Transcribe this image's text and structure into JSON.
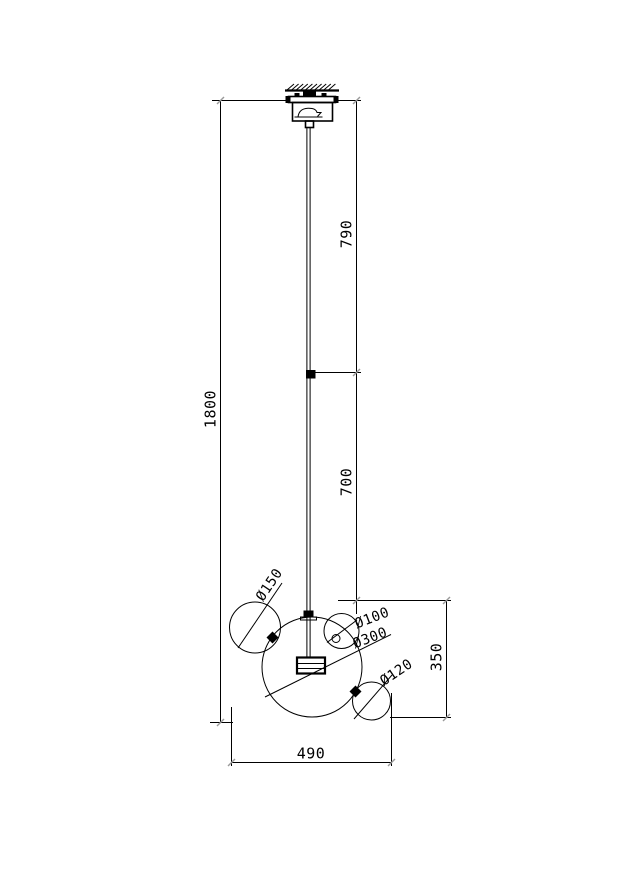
{
  "colors": {
    "background": "#ffffff",
    "line": "#000000",
    "text": "#000000",
    "tick_mark": "#999999"
  },
  "dimensions": {
    "overall_height": "1800",
    "upper_section": "790",
    "lower_section": "700",
    "shade_cluster_height": "350",
    "shade_cluster_width": "490"
  },
  "diameters": {
    "side_sphere": "Ø150",
    "top_small_sphere": "Ø100",
    "main_sphere": "Ø300",
    "bottom_small_sphere": "Ø120"
  }
}
